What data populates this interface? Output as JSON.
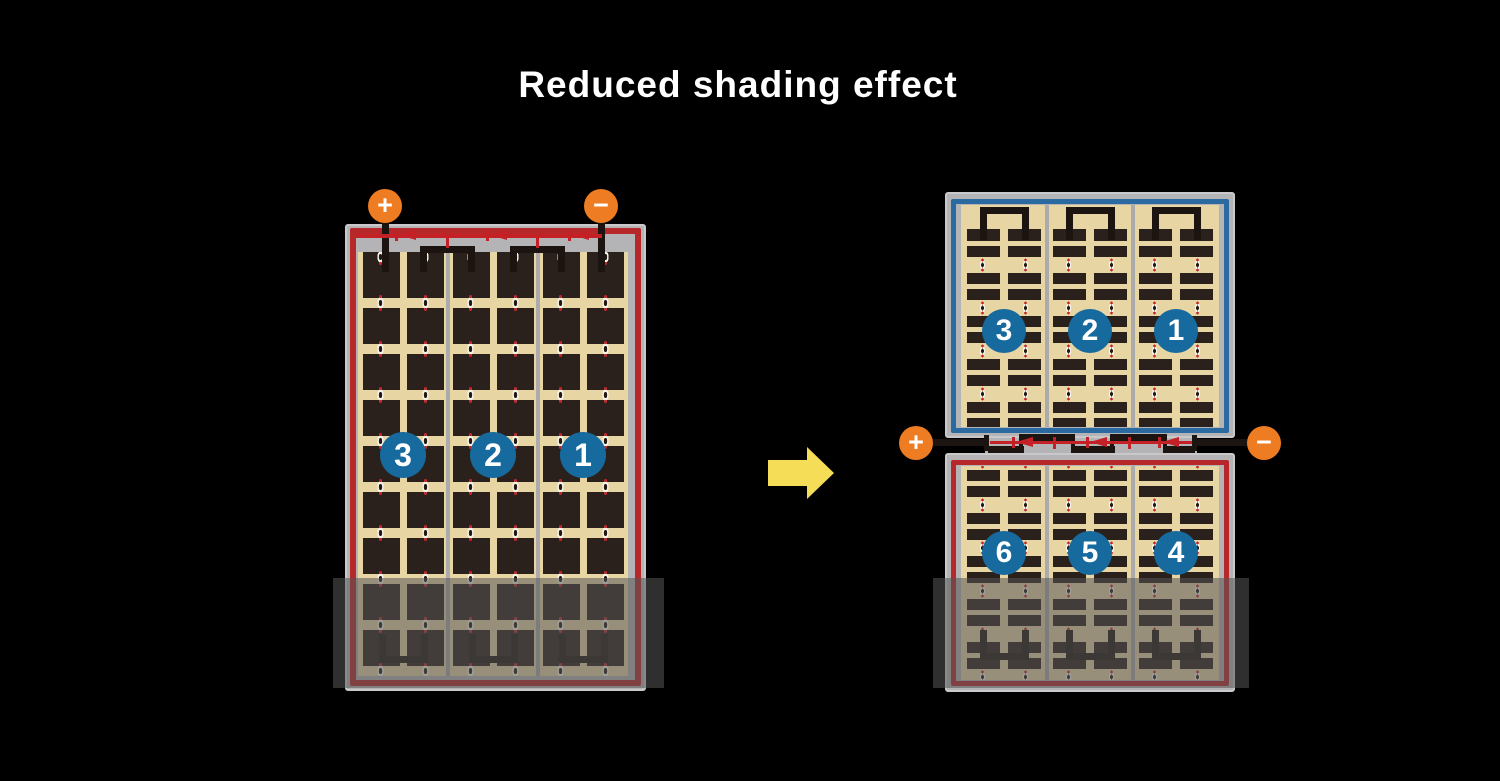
{
  "title": "Reduced shading effect",
  "terminals": {
    "positive": "+",
    "negative": "−"
  },
  "left_module": {
    "string_labels": [
      "3",
      "2",
      "1"
    ]
  },
  "right_module": {
    "top_string_labels": [
      "3",
      "2",
      "1"
    ],
    "bottom_string_labels": [
      "6",
      "5",
      "4"
    ]
  },
  "colors": {
    "background": "#000000",
    "title_text": "#ffffff",
    "frame_gray": "#b4b4b6",
    "cell_tan": "#e7d6a4",
    "cell_dark": "#2b211c",
    "border_red": "#b7282b",
    "border_blue": "#2b6aa1",
    "bypass_diode_red": "#c42127",
    "terminal_orange": "#ee7c22",
    "string_badge_blue": "#176a9e",
    "arrow_yellow": "#f6dd57",
    "shading_overlay": "rgba(85,85,85,0.55)"
  }
}
